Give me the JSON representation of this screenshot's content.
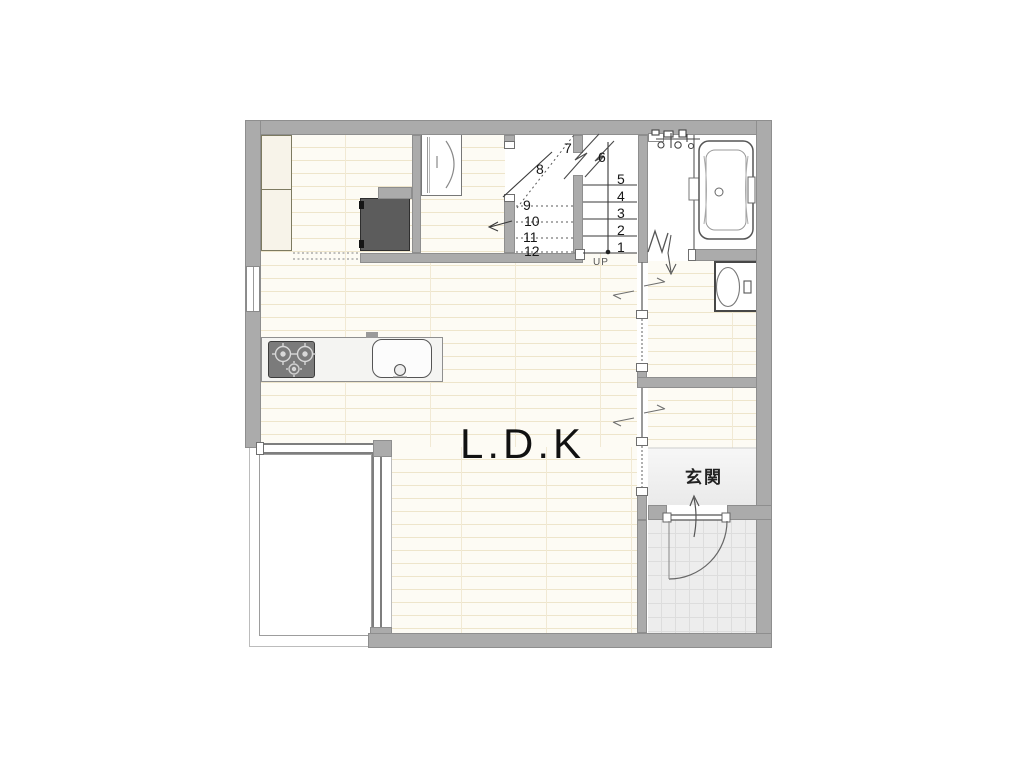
{
  "plan": {
    "labels": {
      "ldk": "L.D.K",
      "entrance": "玄関",
      "up": "UP"
    },
    "stairs": {
      "steps": [
        "1",
        "2",
        "3",
        "4",
        "5",
        "6",
        "7",
        "8",
        "9",
        "10",
        "11",
        "12"
      ]
    },
    "colors": {
      "wall": "#ababab",
      "wall_edge": "#8e8e8e",
      "floor": "#fdfbf4",
      "plank_line": "#eee5cb",
      "appliance_dark": "#5c5c5c",
      "tile_floor": "#ededed",
      "line": "#555555"
    }
  }
}
